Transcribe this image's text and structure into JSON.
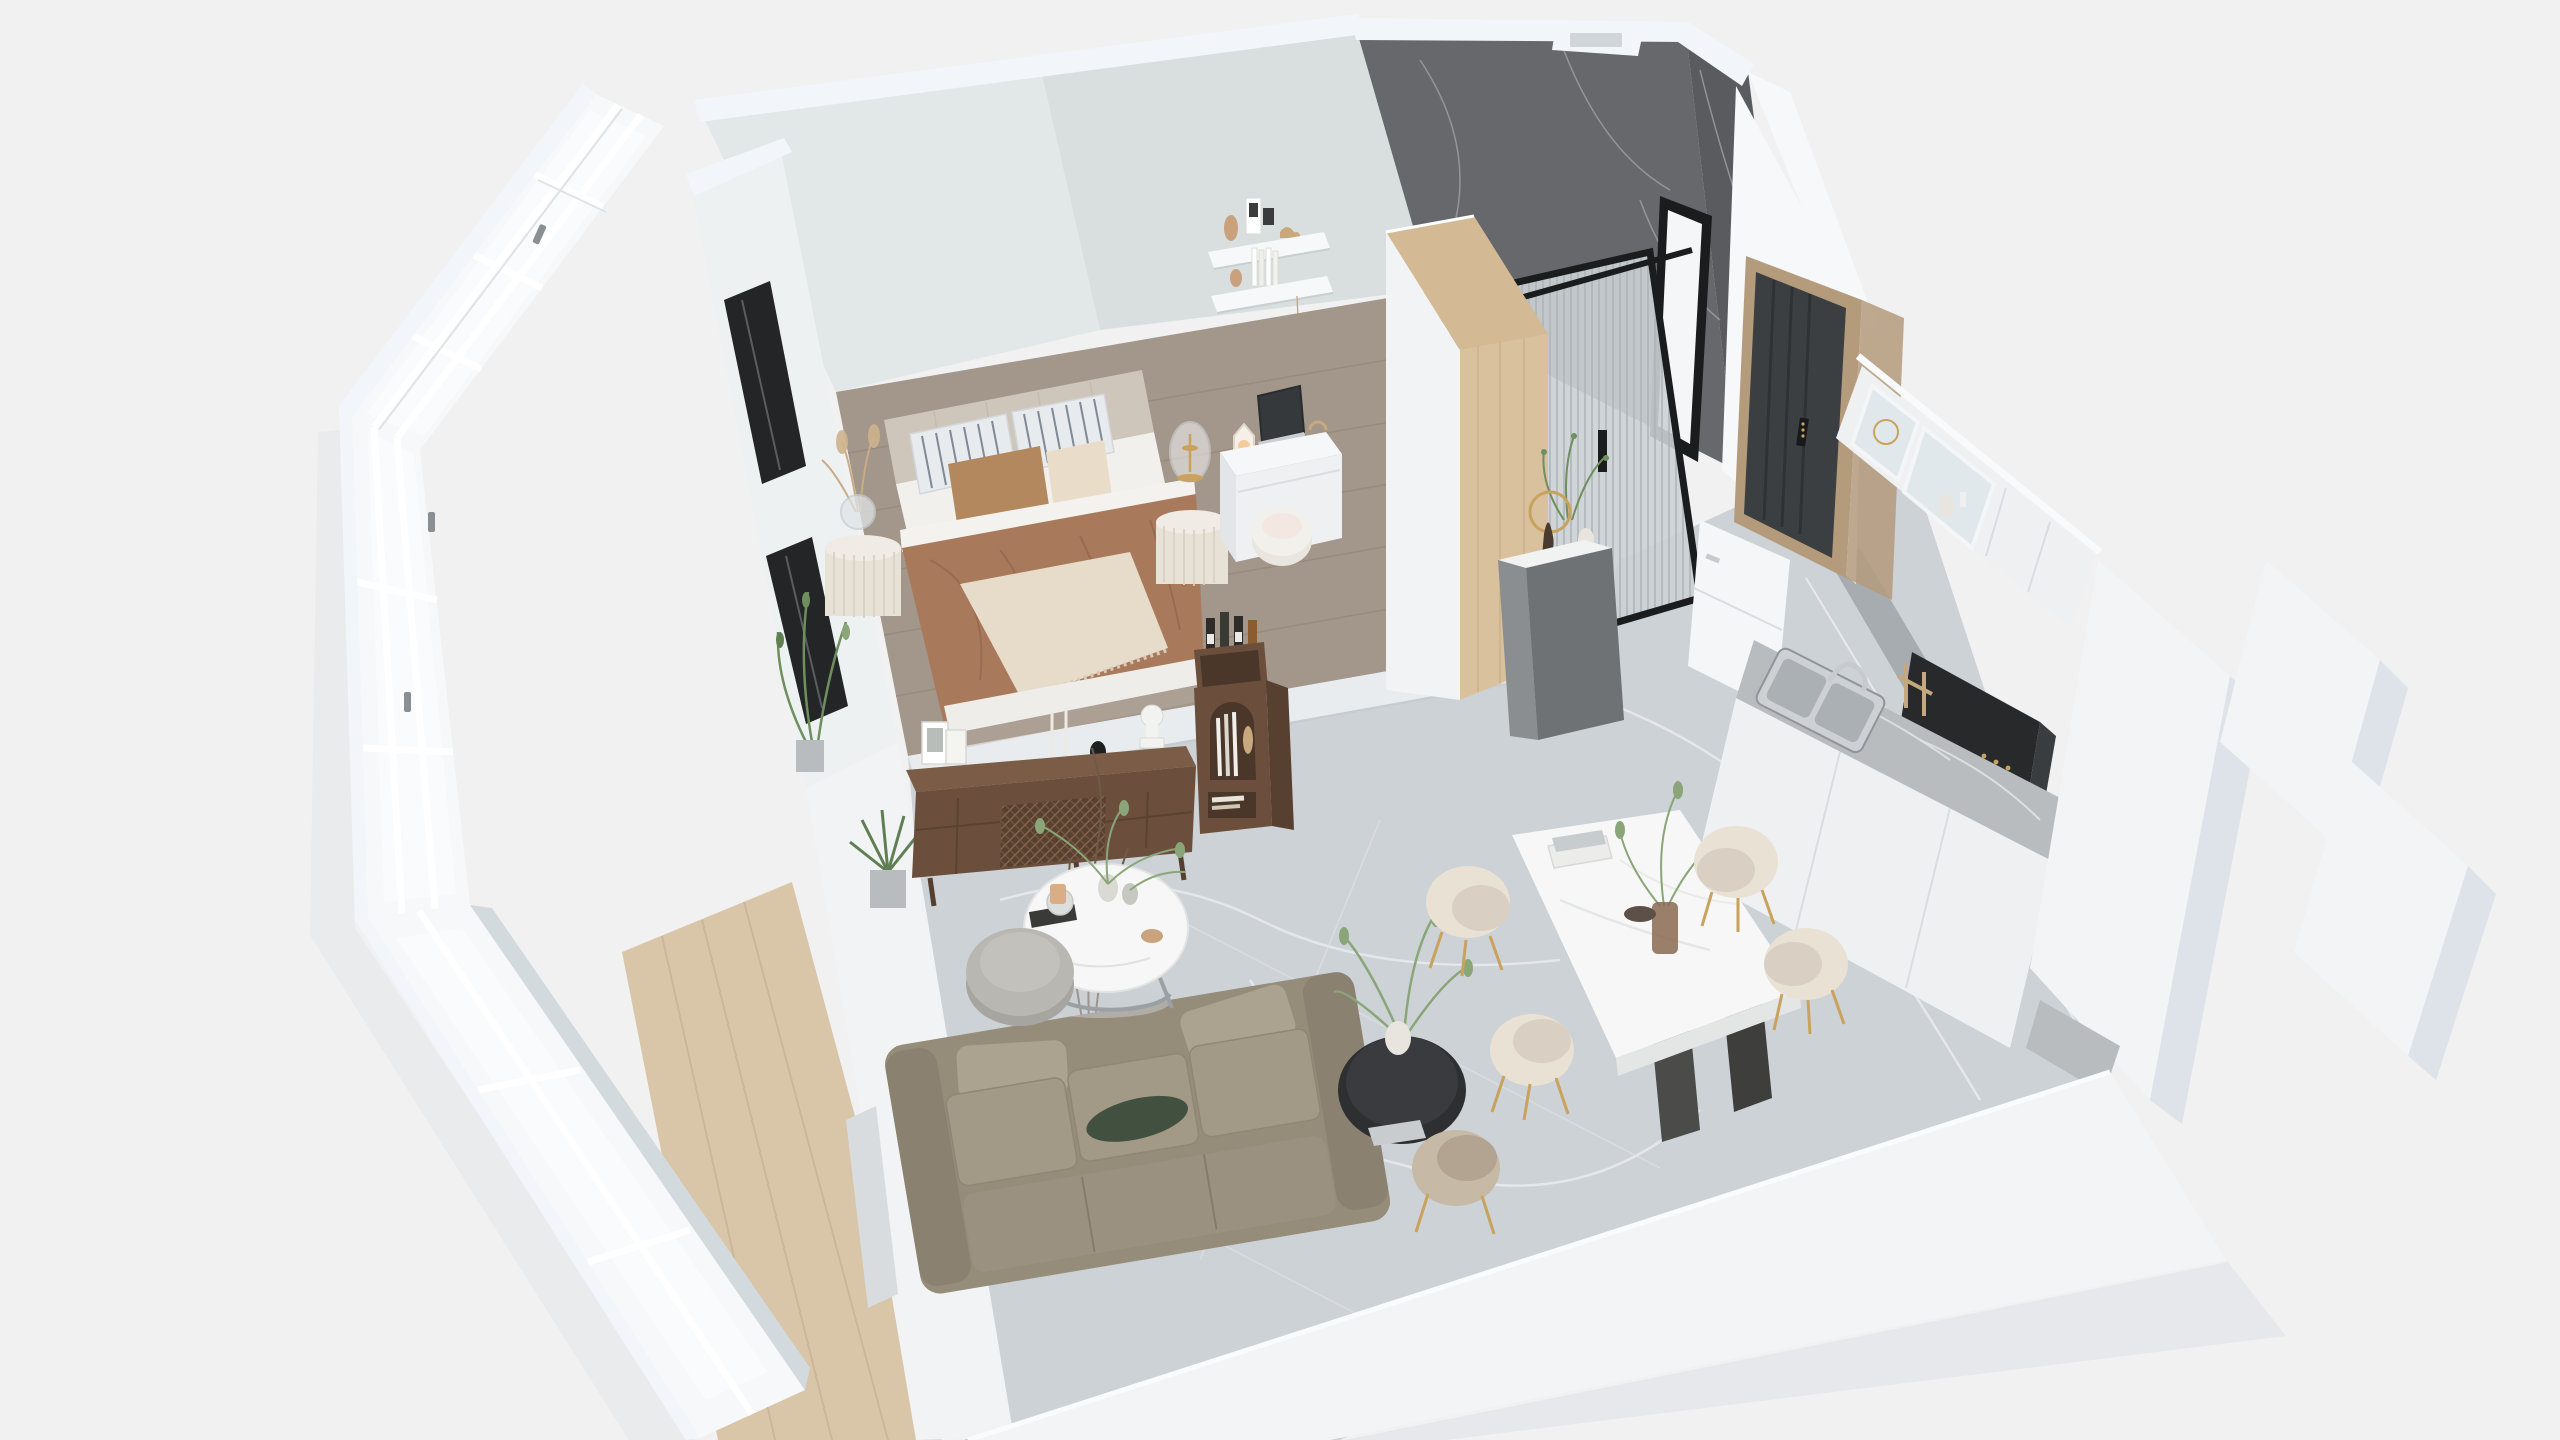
{
  "meta": {
    "title": "3D isometric cutaway floor plan render of a studio apartment",
    "view": "axonometric dollhouse view, no on-screen text or UI controls"
  },
  "scene": {
    "rooms": [
      {
        "name": "bedroom",
        "floor": "grey-taupe wood planks on raised platform",
        "items": [
          "upholstered double bed",
          "channel-tufted greige headboard",
          "two grey striped pillows",
          "camel velvet cushion",
          "cream quilted lumbar cushion",
          "white sheets",
          "camel brown duvet",
          "cream fringed throw",
          "fluted white nightstand left with glass ball vase and pampas",
          "fluted white nightstand right with glass dome gold lamp",
          "white desk with open laptop and mini lamp",
          "white round stool",
          "two white floating wall shelves with books card toy vase",
          "hanging gold star",
          "potted green plants by window"
        ]
      },
      {
        "name": "bathroom",
        "floor": "light marble",
        "items": [
          "dark grey marble veined walls",
          "white wall caps with niche",
          "black framed ribbed glass shower screen",
          "black framed mirror",
          "grey hall console with marble top",
          "figurine with gold ring light",
          "green plant and white vase"
        ]
      },
      {
        "name": "entry",
        "items": [
          "charcoal grooved entry door",
          "digital smart lock",
          "tan wood door frame"
        ]
      },
      {
        "name": "kitchen",
        "items": [
          "white upper cabinets with two glass doors and vases",
          "black range hood",
          "wood utensil rack",
          "grey marble countertop",
          "stainless double sink with arc faucet",
          "black gas cooktop with two burners",
          "white lower cabinets",
          "white appliance cabinet",
          "marble wrapped end column",
          "stepped white outer walls"
        ]
      },
      {
        "name": "dining",
        "items": [
          "white marble rectangular table",
          "two dark angled panel legs",
          "four cream shell-back chairs with gold legs",
          "amber glass vase with green branches",
          "stack of books",
          "black round side table with white vase and plant",
          "grey-tan chair"
        ]
      },
      {
        "name": "living",
        "floor": "light grey marble tile",
        "items": [
          "olive-taupe three seat sofa",
          "two bolster pillows",
          "dark green accent pillow",
          "round white marble coffee table with metal legs",
          "tray with cup and mug",
          "two vases with eucalyptus",
          "grey round ottoman",
          "walnut media console with rattan mesh panel",
          "picture frames",
          "white bust sculpture",
          "candlesticks",
          "walnut arched bookshelf with wine bottles and books",
          "square concrete planter with dried branches",
          "spiky plant in silver pot"
        ]
      },
      {
        "name": "balcony",
        "floor": "light oak planks",
        "items": [
          "white mullioned window wall with handles",
          "interior wall with two black framed window slits"
        ]
      }
    ]
  },
  "palette": {
    "bg": "#f1f1f2",
    "outerShadow": "#e7e8ea",
    "slabWhite": "#f2f4f5",
    "slabShadow": "#e2e4e6",
    "wallWhite": "#f6f8fa",
    "wallCap": "#f2f6fa",
    "wallShade": "#dde3e8",
    "wallReveal": "#d3dade",
    "glassPane": "#fafbfc",
    "mullionShadow": "#d9dee2",
    "handleGrey": "#8a8f93",
    "innerWall": "#eef1f2",
    "innerWallLiving": "#f1f3f5",
    "openingGrey": "#d8dcdf",
    "blackFrame": "#232527",
    "backWallL": "#e2e7e7",
    "backWallR": "#d9dfdf",
    "shelfWhite": "#f6f8f9",
    "shelfShadow": "#c9cfd0",
    "woodFloor": "#a3968a",
    "woodLine": "#8f8375",
    "balconyWood": "#d9c6a8",
    "balconyLine": "#c5b190",
    "stepEdge": "#e8ecee",
    "stepShade": "#c6ccd0",
    "marbleFloor": "#cdd2d6",
    "marbleVein": "#e8ebee",
    "tileLine": "#dfe3e6",
    "borderStrip": "#a7acb0",
    "groutWhite": "#eef1f3",
    "darkMarbleA": "#66686b",
    "darkMarbleB": "#595b5e",
    "marbleVeinDark": "#9fa1a4",
    "showerGlass": "#ccd1d4",
    "showerRib": "#aeb4b8",
    "frameBlack": "#1b1c1e",
    "mirrorGlass": "#f4f6f7",
    "wardrobeOak": "#d9c19e",
    "wardrobeOakTop": "#d3ba95",
    "oakGrain": "#c4a87e",
    "wardrobeWhite": "#f2f3f4",
    "consoleGrey": "#8b8e90",
    "consoleGreySide": "#6f7274",
    "consoleTop": "#f1f2f2",
    "gold": "#c9a25e",
    "plantGreen": "#6f8f5f",
    "plantLight": "#8aa678",
    "plantDark": "#5f7f52",
    "doorCharcoal": "#3b3f42",
    "doorGroove": "#2e3235",
    "doorFrameTan": "#b49b7c",
    "lockBlack": "#17191b",
    "cabinetWhite": "#eef0f2",
    "cabinetSeam": "#d8dde1",
    "glassCabinet": "#dfe7eb",
    "hoodBlack": "#27292b",
    "hoodSide": "#3a3d40",
    "counterMarble": "#b8bcbf",
    "counterVein": "#dfe2e4",
    "steel": "#c7cbce",
    "steelDark": "#8f959a",
    "sinkSteel": "#cdd1d4",
    "cooktopBlack": "#1f2224",
    "applianceWhite": "#f4f6f7",
    "tableWhite": "#f6f7f6",
    "tableEdge": "#e4e6e6",
    "tableLeg": "#4b4b49",
    "amberGlass": "#8a6a52",
    "chairCream": "#e9e1d4",
    "chairSeat": "#d9d0c3",
    "chairTan": "#c6b9a6",
    "chairTanSeat": "#b2a491",
    "sofa": "#958c7a",
    "sofaArm": "#8a8170",
    "sofaSeat": "#a29a87",
    "sofaBack": "#9a9180",
    "sofaPillow": "#aba28f",
    "pillowGreen": "#41503f",
    "ottoman": "#b9b7b1",
    "ottomanShade": "#a7a5a0",
    "sideTableBlack": "#2e2f31",
    "sideTableTop": "#3a3b3e",
    "walnut": "#6b4f3c",
    "walnutTop": "#7b5d47",
    "walnutDark": "#57402f",
    "walnutInner": "#4a372a",
    "rattan": "#8a6a50",
    "bustWhite": "#f2f2f0",
    "bottleDark": "#2e2b28",
    "labelWhite": "#eceae6",
    "headboard": "#cfc6bb",
    "mattressWhite": "#f2f0ed",
    "sheetWhite": "#f4f2ef",
    "duvetBrown": "#a87a5b",
    "duvetFold": "#91674b",
    "throwCream": "#e7dbca",
    "fringe": "#d9c9b4",
    "pillowBase": "#e8ebee",
    "pillowStripe": "#6e7987",
    "cushionTan": "#b3885f",
    "cushionCream": "#e9ddc9",
    "nightstand": "#e8e1d6",
    "nightstandTop": "#f0ebe4",
    "flute": "#d9d1c4",
    "lampGlass": "#f3f5f6",
    "glassStroke": "#d4d9dc",
    "vaseWhite": "#e8e4de",
    "silverPot": "#b9bcbe",
    "concretePot": "#a9a9a6",
    "bookWhite": "#fdfdfd",
    "deskWhite": "#f6f7f8",
    "deskFront": "#eef0f2",
    "deskSide": "#e2e6e9",
    "laptopDark": "#36393c",
    "laptopBase": "#c9ced2",
    "glow": "#f4c894",
    "shadowSoft": "#b9b0a6"
  }
}
